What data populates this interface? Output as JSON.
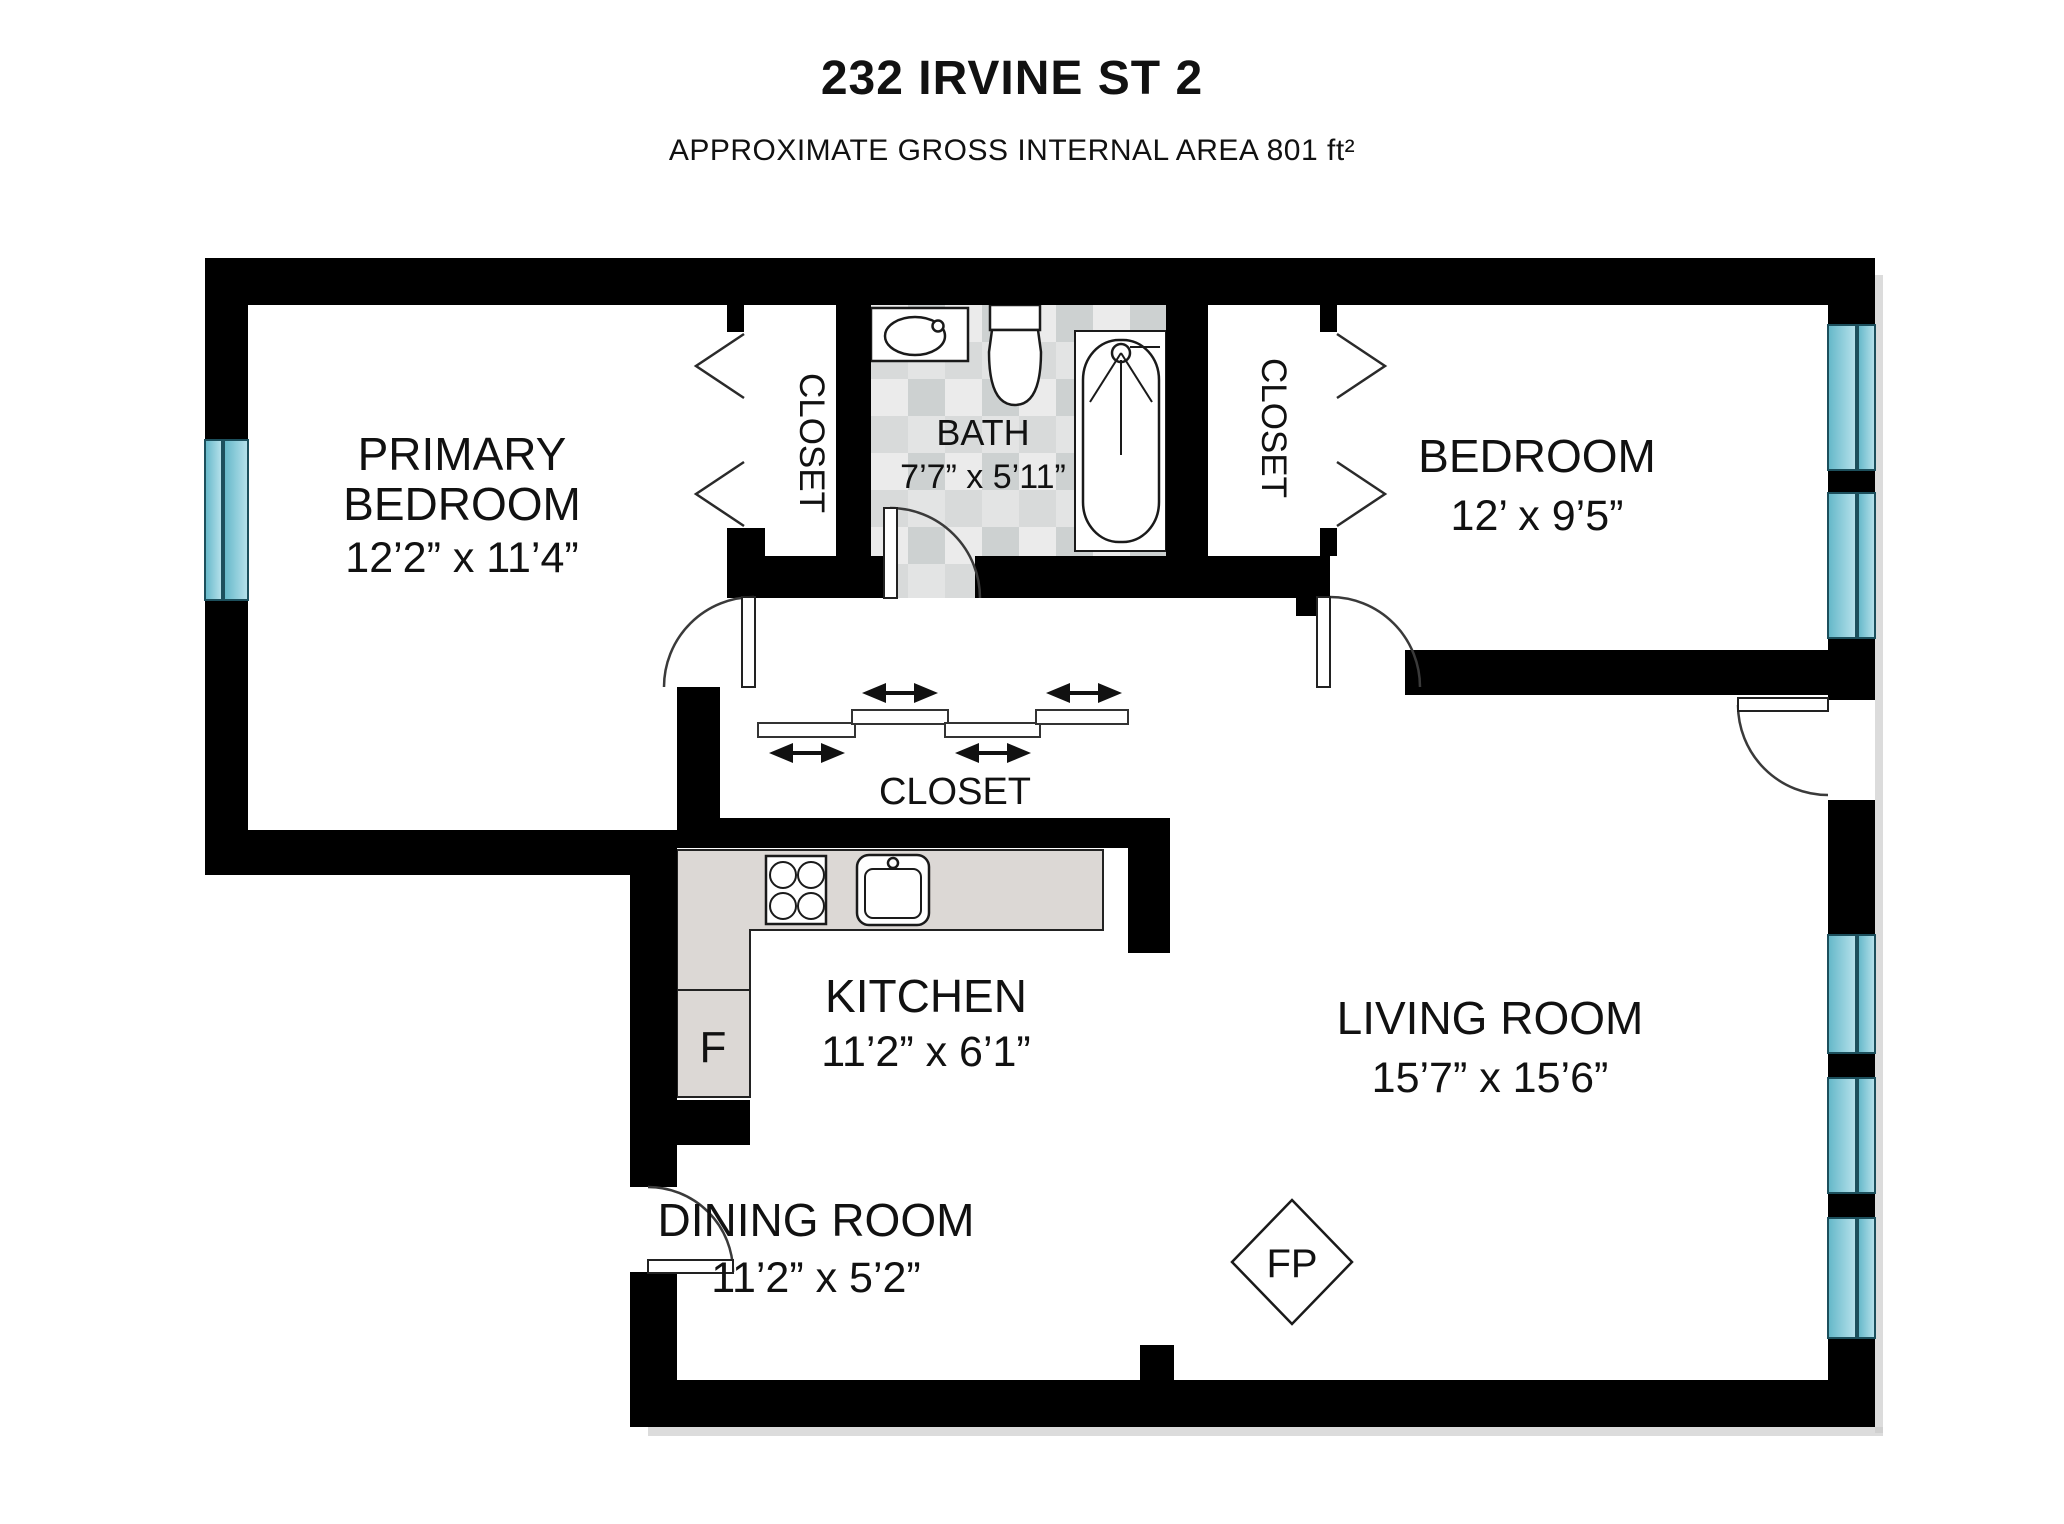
{
  "header": {
    "title": "232 IRVINE ST 2",
    "subtitle": "APPROXIMATE GROSS INTERNAL AREA 801 ft²"
  },
  "rooms": {
    "primary_bedroom": {
      "name_line1": "PRIMARY",
      "name_line2": "BEDROOM",
      "dims": "12’2” x 11’4”"
    },
    "bedroom": {
      "name": "BEDROOM",
      "dims": "12’ x 9’5”"
    },
    "bath": {
      "name": "BATH",
      "dims": "7’7” x 5’11”"
    },
    "kitchen": {
      "name": "KITCHEN",
      "dims": "11’2” x 6’1”"
    },
    "dining_room": {
      "name": "DINING ROOM",
      "dims": "11’2” x 5’2”"
    },
    "living_room": {
      "name": "LIVING ROOM",
      "dims": "15’7” x 15’6”"
    },
    "closet_left": {
      "name": "CLOSET"
    },
    "closet_right": {
      "name": "CLOSET"
    },
    "closet_hall": {
      "name": "CLOSET"
    }
  },
  "markers": {
    "fridge": "F",
    "fireplace": "FP"
  },
  "fixtures": [
    "bathroom-sink",
    "toilet",
    "bathtub",
    "stove",
    "kitchen-sink",
    "fireplace",
    "fridge"
  ],
  "colors": {
    "wall": "#000000",
    "window_glass_dark": "#63b7c8",
    "window_glass_light": "#b8e2ec",
    "tile_light": "#ebebeb",
    "tile_dark": "#cdd1d1",
    "counter": "#dcd8d5",
    "text": "#111111"
  }
}
